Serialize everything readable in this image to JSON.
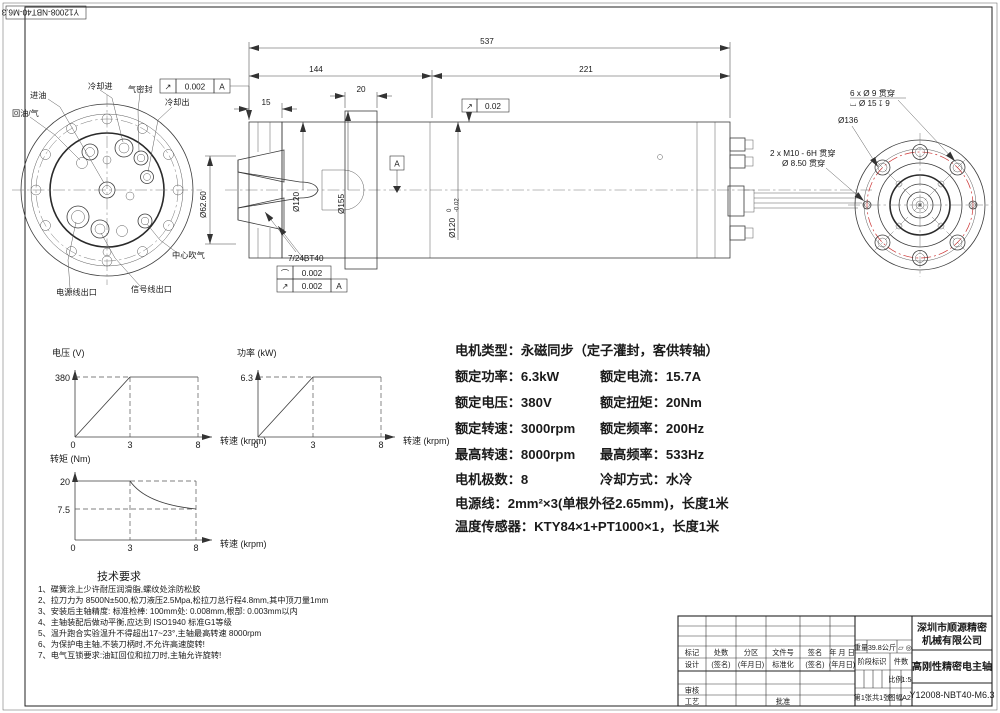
{
  "corner_label": "Y12008-NBT40-M6.3",
  "front_view": {
    "labels": {
      "oil_in": "进油",
      "coolant_in": "冷却进",
      "air_seal": "气密封",
      "coolant_out": "冷却出",
      "oil_return": "回油/气",
      "center_air": "中心吹气",
      "power_outlet": "电源线出口",
      "signal_outlet": "信号线出口"
    },
    "runout_frame": {
      "symbol": "↗",
      "value": "0.002",
      "datum": "A"
    }
  },
  "side_view": {
    "dim_overall": "537",
    "dim_front": "144",
    "dim_rear": "221",
    "dim_flange_width": "20",
    "dim_nose": "15",
    "dim_taper_dia": "Ø62.60",
    "dim_body_dia": "Ø120",
    "dim_flange_dia": "Ø155",
    "fit_dia": "Ø120",
    "fit_tol_upper": "0",
    "fit_tol_lower": "-0.02",
    "taper_label": "7/24BT40",
    "datum_label": "A",
    "runout_frame2": {
      "symbol": "↗",
      "value": "0.02"
    },
    "profile_frame": {
      "row1_symbol": "⌒",
      "row1_value": "0.002",
      "row2_symbol": "↗",
      "row2_value": "0.002",
      "row2_datum": "A"
    }
  },
  "rear_view": {
    "labels": {
      "holes": "6 x Ø 9 贯穿",
      "cbore": "⌴ Ø 15 ↧ 9",
      "bolt_circle": "Ø136",
      "tapped": "2 x M10 - 6H 贯穿",
      "through": "Ø 8.50 贯穿"
    }
  },
  "chart_data": [
    {
      "type": "line",
      "title": "电压-转速特性",
      "ylabel": "电压 (V)",
      "xlabel": "转速 (krpm)",
      "x_ticks": [
        "0",
        "3",
        "8"
      ],
      "y_peak_label": "380",
      "x": [
        0,
        3,
        8
      ],
      "y": [
        0,
        380,
        380
      ],
      "xlim": [
        0,
        9
      ],
      "ylim": [
        0,
        430
      ],
      "grid": "dashed reference lines at y=380, x=3, x=8",
      "legend": "none"
    },
    {
      "type": "line",
      "title": "功率-转速特性",
      "ylabel": "功率 (kW)",
      "xlabel": "转速 (krpm)",
      "x_ticks": [
        "0",
        "3",
        "8"
      ],
      "y_peak_label": "6.3",
      "x": [
        0,
        3,
        8
      ],
      "y": [
        0,
        6.3,
        6.3
      ],
      "xlim": [
        0,
        9
      ],
      "ylim": [
        0,
        7.2
      ],
      "grid": "dashed reference lines at y=6.3, x=3, x=8",
      "legend": "none"
    },
    {
      "type": "line",
      "title": "转矩-转速特性",
      "ylabel": "转矩 (Nm)",
      "xlabel": "转速 (krpm)",
      "x_ticks": [
        "0",
        "3",
        "8"
      ],
      "y_tick_labels": [
        "20",
        "7.5"
      ],
      "x": [
        0,
        3,
        8
      ],
      "y": [
        20,
        20,
        7.5
      ],
      "xlim": [
        0,
        9
      ],
      "ylim": [
        0,
        22
      ],
      "curve": "constant 20 Nm to 3 krpm, constant-power decay to 7.5 Nm at 8 krpm",
      "grid": "dashed reference lines at y=20, y=7.5, x=3, x=8",
      "legend": "none"
    }
  ],
  "specs": {
    "type_line": "电机类型：永磁同步（定子灌封，客供转轴）",
    "rows": [
      {
        "left": "额定功率：6.3kW",
        "right": "额定电流：15.7A"
      },
      {
        "left": "额定电压：380V",
        "right": "额定扭矩：20Nm"
      },
      {
        "left": "额定转速：3000rpm",
        "right": "额定频率：200Hz"
      },
      {
        "left": "最高转速：8000rpm",
        "right": "最高频率：533Hz"
      },
      {
        "left": "电机极数：8",
        "right": "冷却方式：水冷"
      }
    ],
    "power_line": "电源线：2mm²×3(单根外径2.65mm)，长度1米",
    "sensor_line": "温度传感器：KTY84×1+PT1000×1，长度1米"
  },
  "tech": {
    "title": "技术要求",
    "items": [
      "1、碟簧涂上少许耐压润滑脂,螺纹处涂防松胶",
      "2、拉刀力为 8500N±500,松刀液压2.5Mpa,松拉刀总行程4.8mm,其中顶刀量1mm",
      "3、安装后主轴精度: 标准检棒: 100mm处: 0.008mm,根部: 0.003mm以内",
      "4、主轴装配后做动平衡,应达到 ISO1940 标准G1等级",
      "5、温升跑合实验温升不得超出17~23°,主轴最高转速 8000rpm",
      "6、为保护电主轴,不装刀柄时,不允许高速旋转!",
      "7、电气互锁要求:油缸回位和拉刀时,主轴允许旋转!"
    ]
  },
  "title_block": {
    "company_line1": "深圳市顺源精密",
    "company_line2": "机械有限公司",
    "product": "高刚性精密电主轴",
    "drawing_no": "Y12008-NBT40-M6.3",
    "h_mark": "标记",
    "h_count": "处数",
    "h_zone": "分区",
    "h_doc": "文件号",
    "h_sign": "签名",
    "h_date": "年 月 日",
    "d_design": "设计",
    "d_sign": "(签名)",
    "d_date": "(年月日)",
    "d_std": "标准化",
    "d_sign2": "(签名)",
    "d_date2": "(年月日)",
    "review": "审核",
    "process": "工艺",
    "approve": "批准",
    "weight_label": "重量",
    "weight_value": "39.8公斤",
    "projection_symbols": "▱ ◎",
    "stage_label": "阶段标识",
    "qty_label": "件数",
    "scale_label": "比例",
    "scale_value": "1:5",
    "sheet_text": "第1张共1张",
    "size_label": "图幅",
    "size_value": "A2"
  }
}
